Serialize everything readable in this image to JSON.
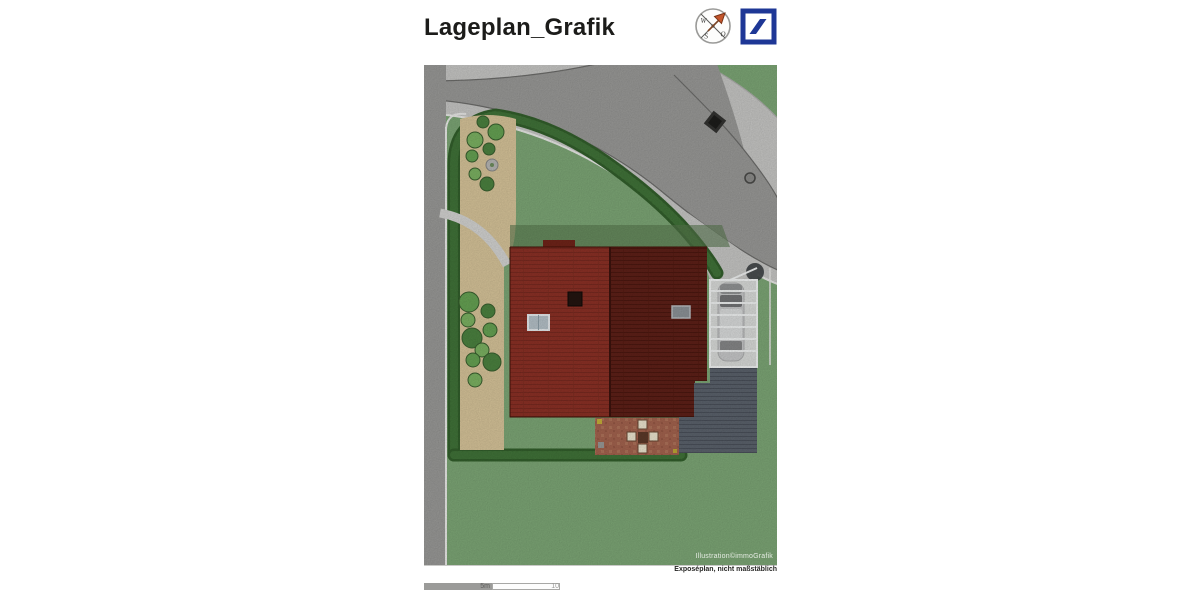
{
  "title": "Lageplan_Grafik",
  "header": {
    "compass": {
      "icon": "compass-rose",
      "west": "W",
      "south": "S",
      "east": "O"
    },
    "logo": {
      "icon": "deutsche-bank-logo"
    }
  },
  "plan": {
    "credit": "Illustration©immoGrafik",
    "disclaimer": "Exposéplan, nicht maßstäblich",
    "features": [
      "curved street",
      "hedge border",
      "gravel beds with shrubs",
      "gabled tiled roof house",
      "skylights",
      "chimney",
      "carport with car",
      "dark wooden terrace",
      "patio with table and four chairs",
      "manhole cover",
      "drain square"
    ]
  },
  "scalebar": {
    "mid": "5m",
    "end": "10"
  },
  "palette": {
    "ink": "#1c1c1a",
    "lawn": "#7ea877",
    "hedge": "#33602c",
    "hedge_light": "#4a8040",
    "road": "#9b9b99",
    "shoulder": "#c9c9c7",
    "curb": "#6e6e6c",
    "white_line": "#ededeb",
    "bed": "#d9c69b",
    "roof_left": "#8d3126",
    "roof_right": "#5f2018",
    "terrace": "#5c636d",
    "carport": "#d9dbdb",
    "patio": "#a5644f",
    "chair": "#efe8d2",
    "db_blue": "#1e3796",
    "compass_arrow": "#c4562c"
  }
}
